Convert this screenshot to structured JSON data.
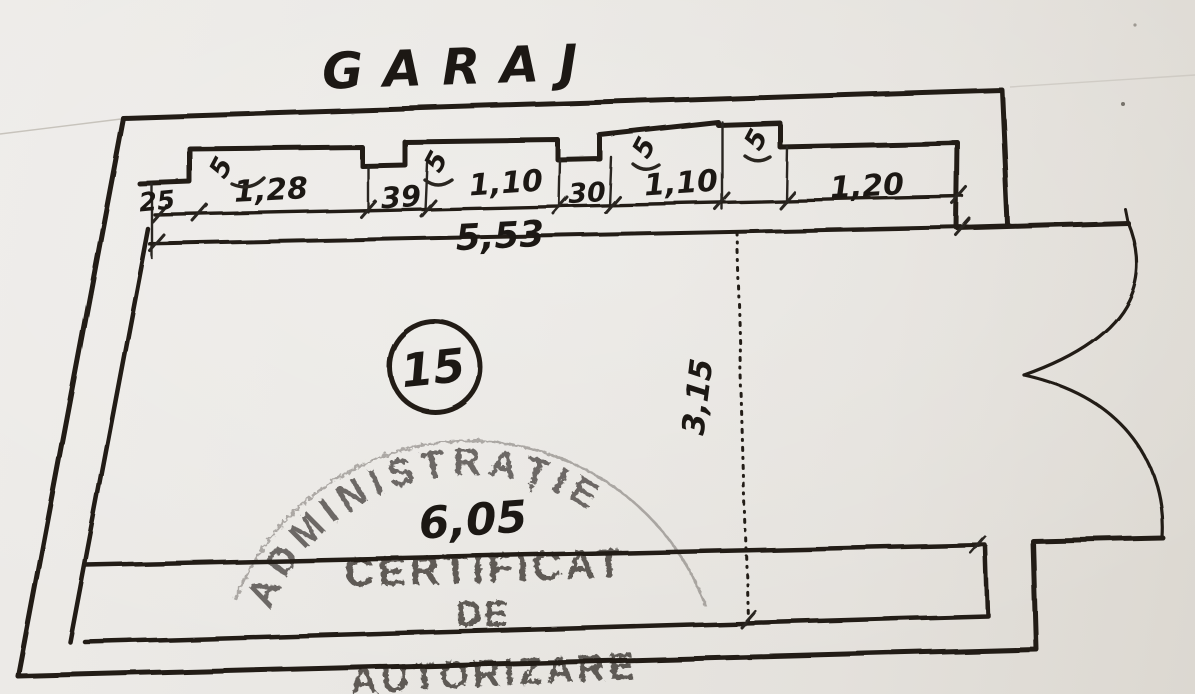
{
  "title": "GARAJ",
  "room": {
    "number": "15"
  },
  "dimensions": {
    "top_segments": [
      "25",
      "1,28",
      "39",
      "1,10",
      "30",
      "1,10",
      "1,20"
    ],
    "top_total": "5,53",
    "depth": "3,15",
    "bottom_total": "6,05",
    "pilaster_marks": [
      "5",
      "5",
      "5",
      "5"
    ]
  },
  "stamp": {
    "arc_text": "ADMINISTRAȚIE",
    "line1": "CERTIFICAT",
    "line2": "DE",
    "line3": "AUTORIZARE"
  },
  "colors": {
    "ink": "#221e19",
    "stamp_ink": "#46423d",
    "paper": "#e8e5e1"
  }
}
